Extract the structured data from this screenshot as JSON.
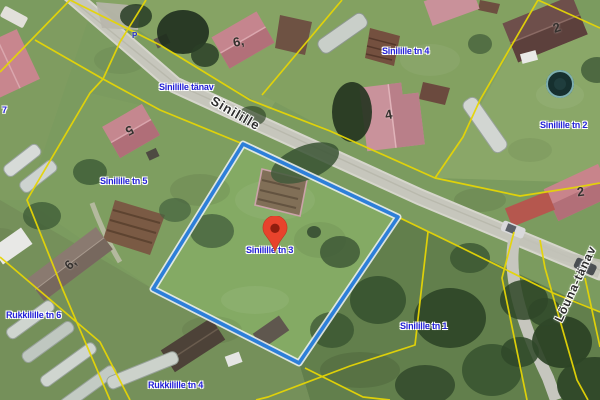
{
  "map": {
    "labels": {
      "street_name_full": "Sinilille tänav",
      "road_name_diagonal": "Sinilille",
      "side_road_name": "Lõuna-tänav",
      "parcel_tn4": "Sinilille tn 4",
      "parcel_tn2": "Sinilille tn 2",
      "parcel_tn5": "Sinilille tn 5",
      "parcel_tn3": "Sinilille tn 3",
      "parcel_tn1": "Sinilille tn 1",
      "parcel_rukkilille_tn6": "Rukkilille tn 6",
      "parcel_rukkilille_tn4": "Rukkilille tn 4",
      "parcel_fragment_left": "7",
      "parking_symbol": "P"
    },
    "house_numbers": {
      "top_left": "6,",
      "left": "5",
      "center_north": "4",
      "top_right": "2",
      "right": "2",
      "bottom_left": "6,"
    },
    "marker": {
      "at_parcel": "Sinilille tn 3",
      "color": "#e8432c",
      "inner_color": "#8f1d0e"
    },
    "colors": {
      "selected_parcel_outline": "#2d7fd9",
      "cadastral_line": "#e5d506",
      "label_blue": "#2421d8",
      "road_gray": "#c8c8c0"
    }
  }
}
